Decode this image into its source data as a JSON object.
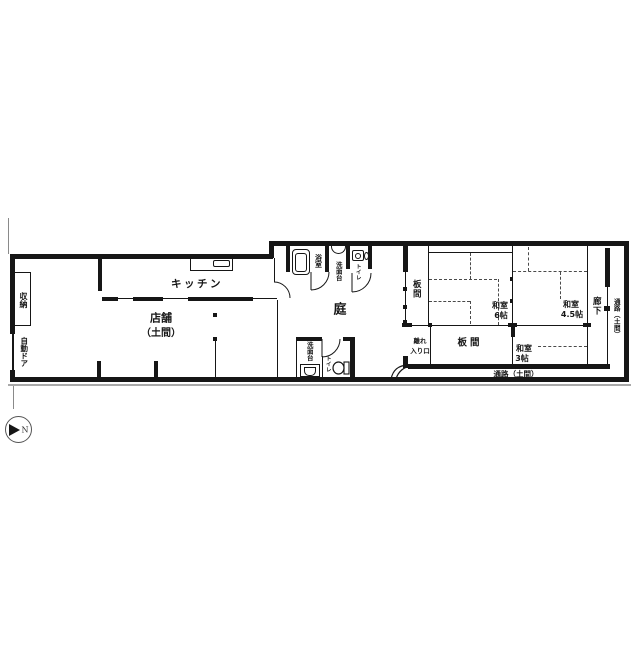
{
  "colors": {
    "wall": "#161616",
    "shadow": "#a9a9a9",
    "tatami_dash": "#4a4a4a"
  },
  "compass": {
    "north_label": "N"
  },
  "labels": {
    "storage": "収納",
    "auto_door": "自動ドア",
    "shop_line1": "店舗",
    "shop_line2": "（土間）",
    "kitchen": "キッチン",
    "bathroom": "浴室",
    "washstand_upper": "洗面台",
    "toilet_upper": "トイレ",
    "garden": "庭",
    "washstand_lower": "洗面台",
    "toilet_lower": "トイレ",
    "board_room_upper": "板間",
    "washitsu6_line1": "和室",
    "washitsu6_line2": "6帖",
    "washitsu45_line1": "和室",
    "washitsu45_line2": "4.5帖",
    "corridor": "廊下",
    "passage_right": "通路（土間）",
    "hanare_line1": "離れ",
    "hanare_line2": "入り口",
    "board_room_lower": "板間",
    "washitsu3_line1": "和室",
    "washitsu3_line2": "3帖",
    "passage_bottom": "通路（土間）"
  }
}
